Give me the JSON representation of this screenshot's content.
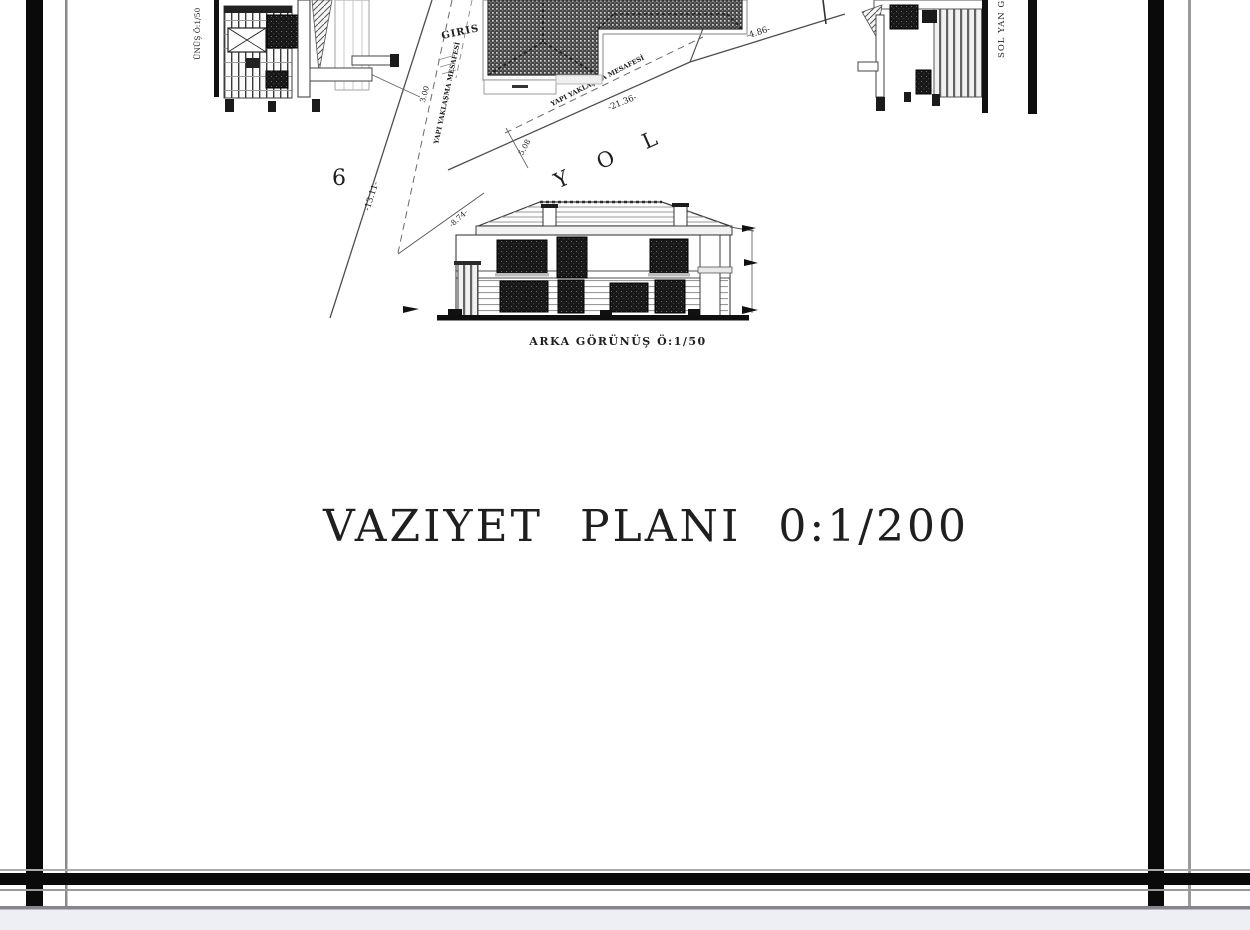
{
  "title": {
    "text": "VAZIYET  PLANI  0:1/200"
  },
  "site_plan": {
    "plot_number": "6",
    "entrance_label": "GIRIS",
    "road_label": "Y O L",
    "setback_label_upper": "YAPI YAKLAŞMA MESAFESİ",
    "setback_label_lower": "YAPI YAKLAŞMA MESAFESİ",
    "dim_left_boundary": "-13.11-",
    "dim_setback": "3.00",
    "dim_road_tick": "5.08",
    "dim_road_frontage": "-21.36-",
    "dim_right_frontage": "-4.86-",
    "dim_rear": "-8.74-"
  },
  "elevations": {
    "left_label": "ÜNÜŞ Ö:1/50",
    "right_label": "SOL YAN G",
    "rear_label": "ARKA GÖRÜNÜŞ Ö:1/50"
  },
  "colors": {
    "ink": "#1c1c1c",
    "paper": "#ffffff",
    "frame": "#0a0a0a",
    "strip": "#edeff5",
    "strip_line": "#85858d"
  }
}
